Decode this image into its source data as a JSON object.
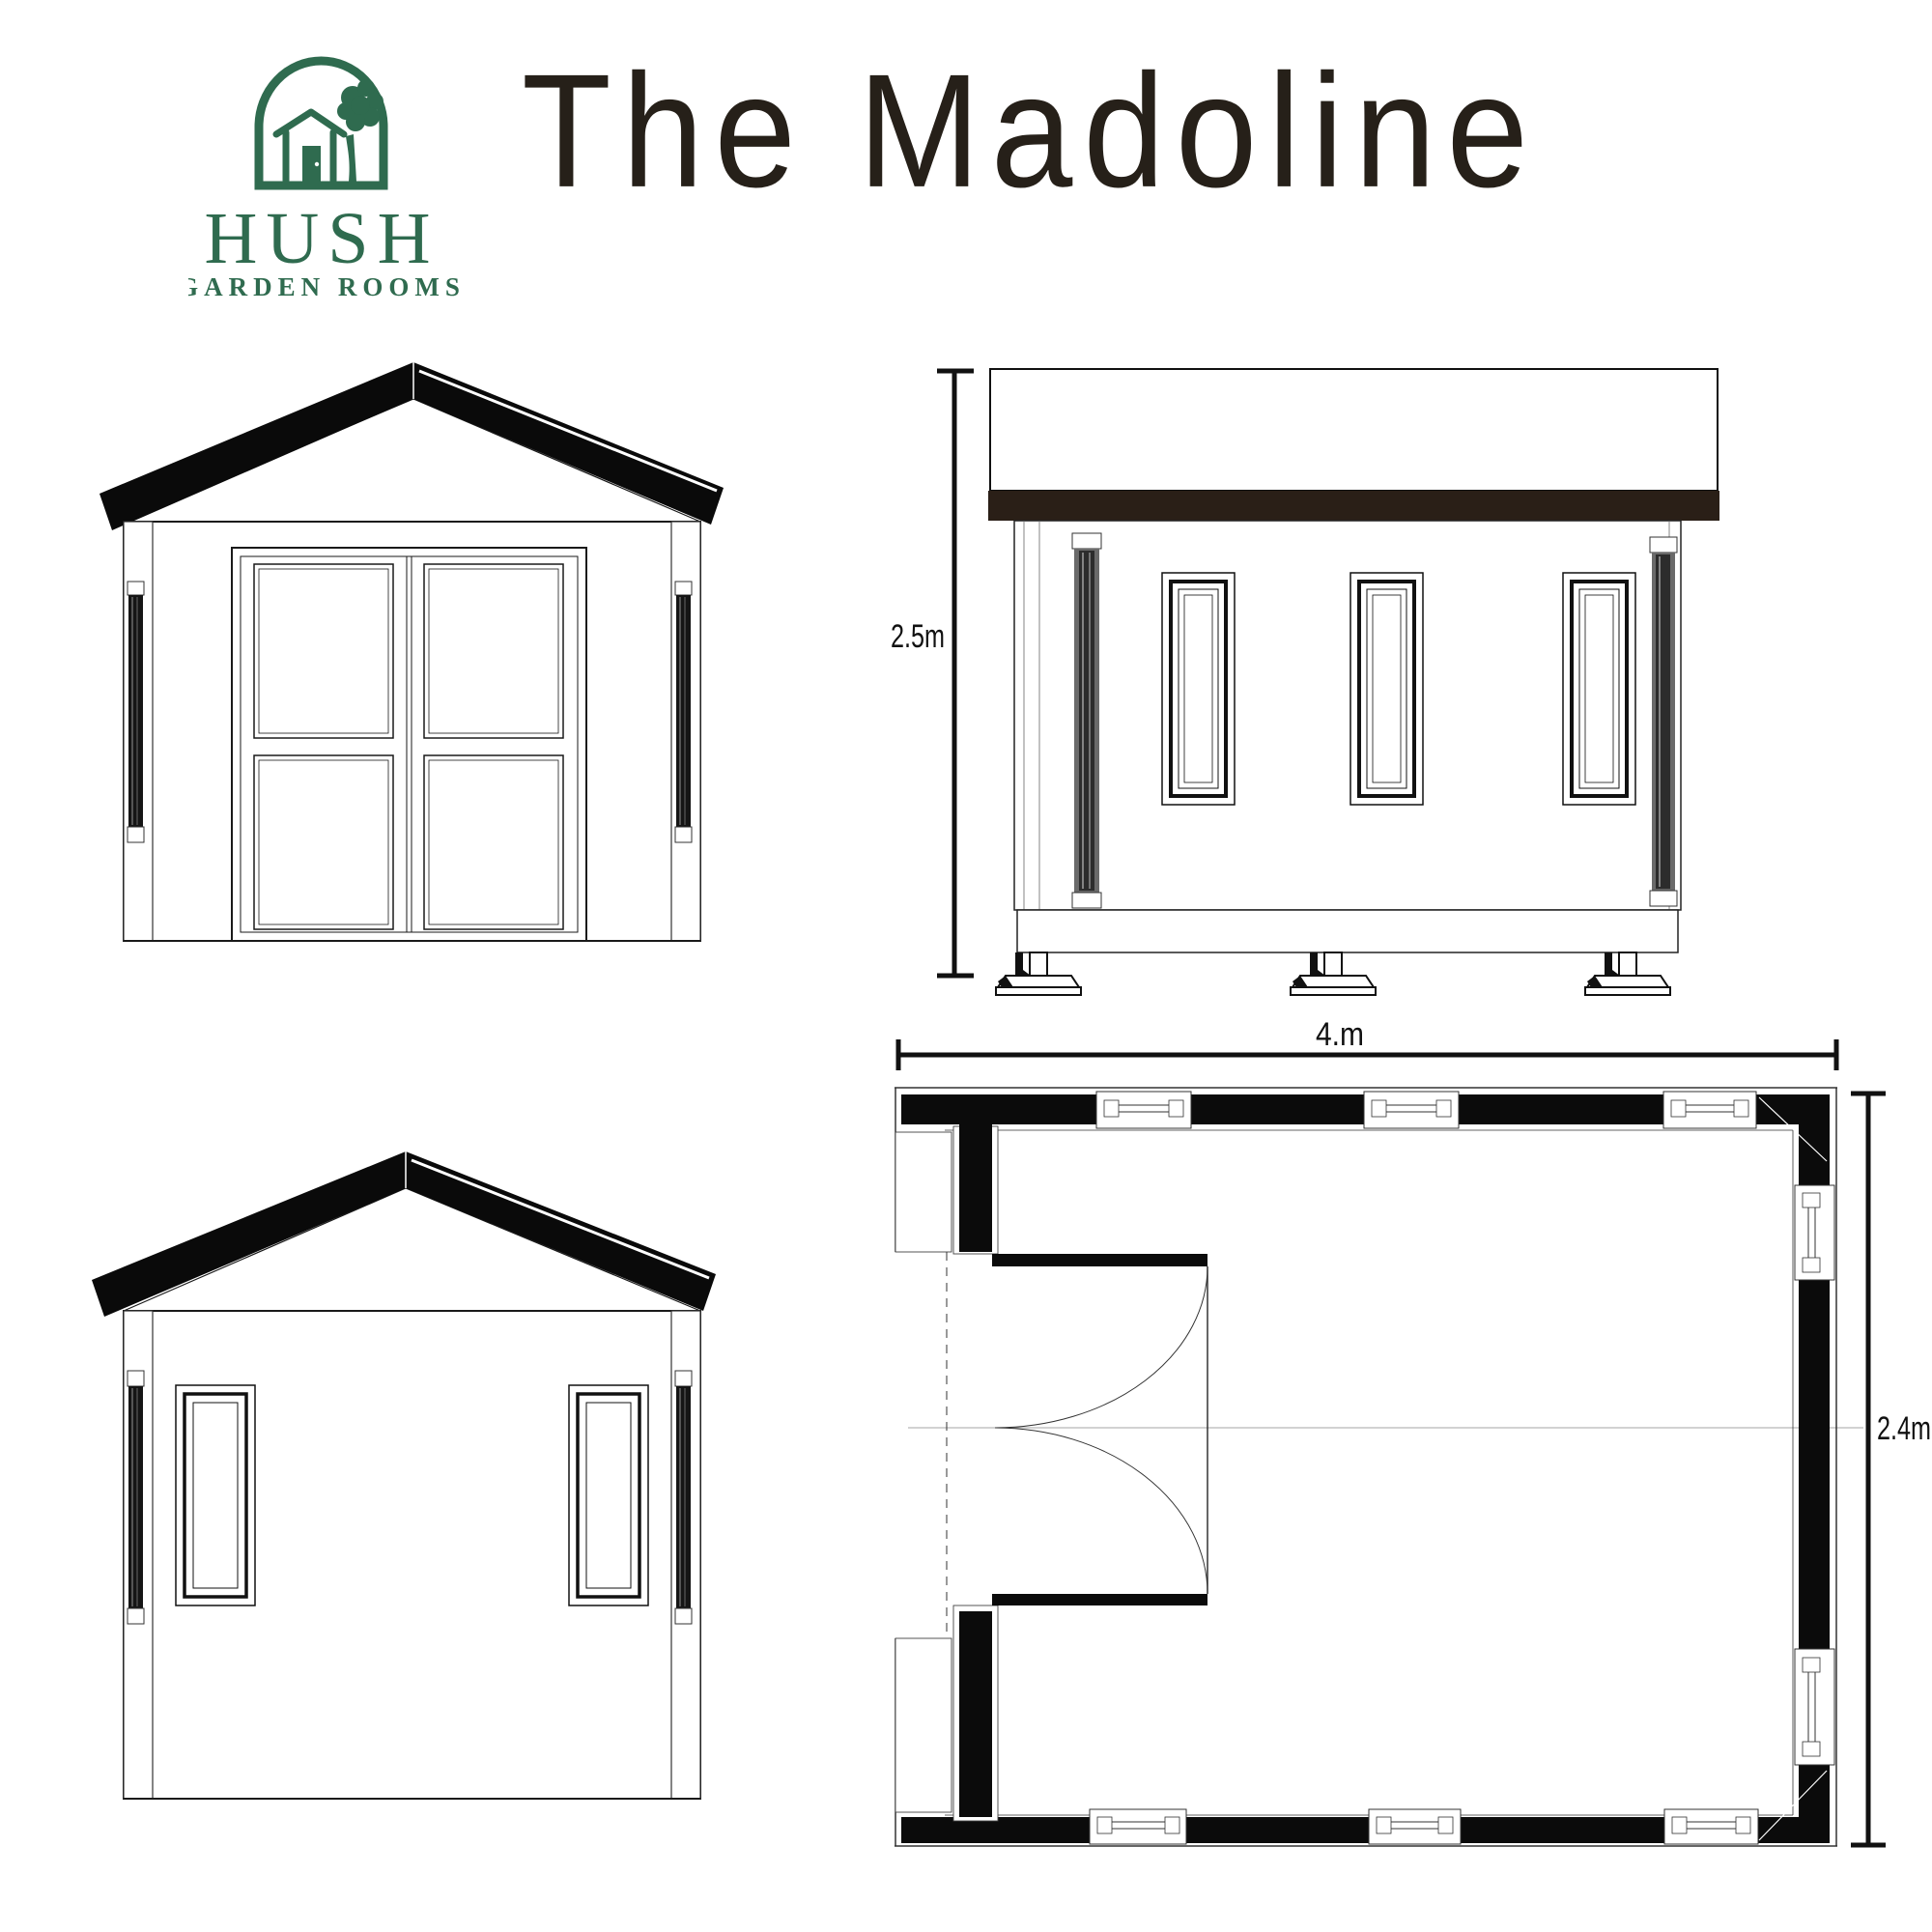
{
  "brand": {
    "name": "HUSH",
    "subtitle": "GARDEN ROOMS",
    "green": "#2F6B4F"
  },
  "title": {
    "text": "The Madoline",
    "color": "#262019"
  },
  "colors": {
    "roof_black": "#0A0A0A",
    "fascia_brown": "#2A1F17",
    "line_ink": "#1A1A1A",
    "background": "#FFFFFF"
  },
  "drawings": {
    "side_elevation": {
      "height_label": "2.5m"
    },
    "floor_plan": {
      "width_label": "4.m",
      "depth_label": "2.4m"
    }
  }
}
